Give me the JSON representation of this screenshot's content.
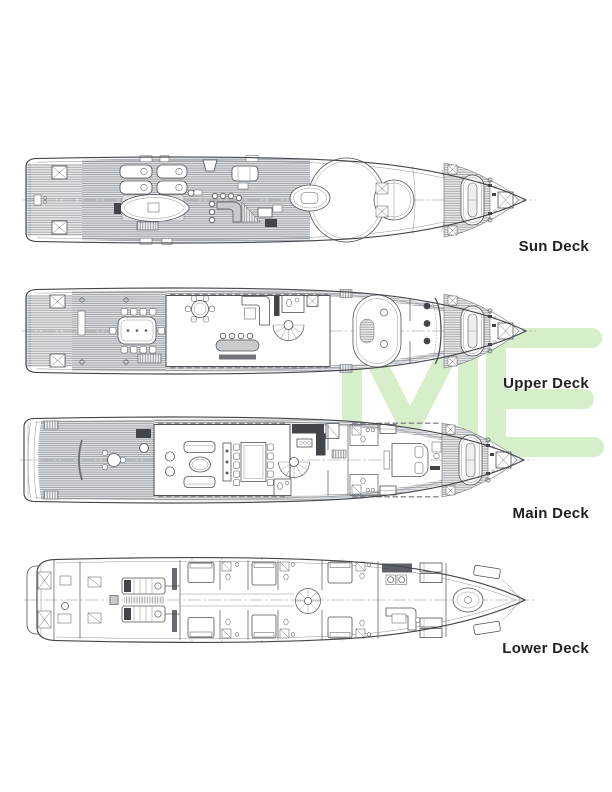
{
  "page": {
    "background": "#ffffff",
    "kind": "yacht-deck-plan-sheet"
  },
  "decks": [
    {
      "id": "sun",
      "label": "Sun Deck"
    },
    {
      "id": "upper",
      "label": "Upper Deck"
    },
    {
      "id": "main",
      "label": "Main Deck"
    },
    {
      "id": "lower",
      "label": "Lower Deck"
    }
  ],
  "watermark": {
    "letters": "ME",
    "color": "#d7eecb"
  },
  "palette": {
    "line": "#43474c",
    "line_light": "#80858a",
    "hatch_line": "#94999e",
    "hatch_bg": "#e6e8e9",
    "furniture_gray": "#c7cbce",
    "dark_fixture": "#42464b",
    "label_text": "#222226"
  }
}
